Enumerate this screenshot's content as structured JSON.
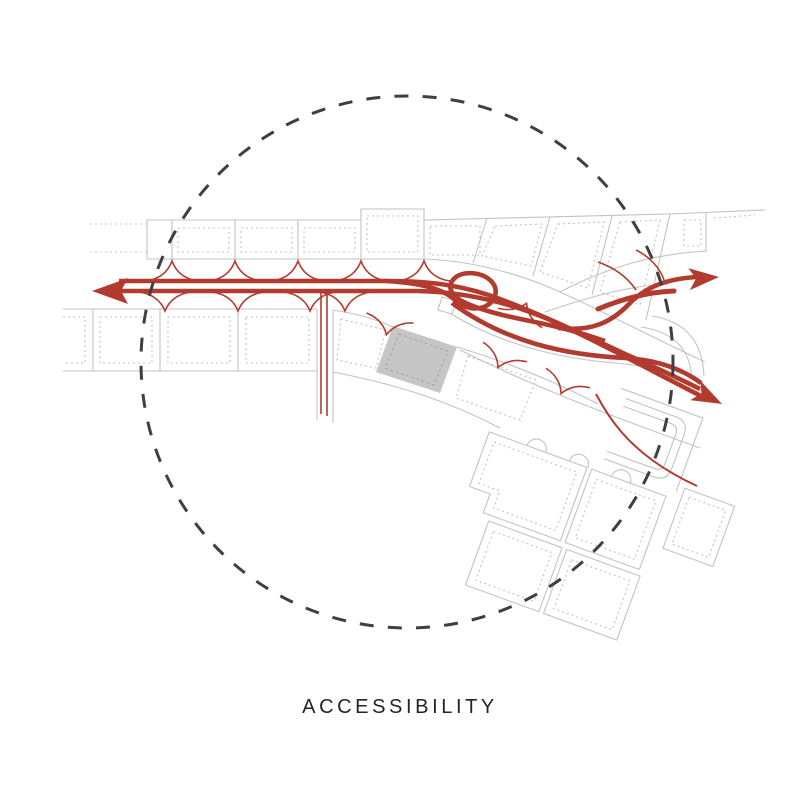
{
  "caption": {
    "label": "ACCESSIBILITY"
  },
  "diagram": {
    "type": "site-accessibility-diagram",
    "features": [
      {
        "name": "radius-circle",
        "style": "dashed"
      },
      {
        "name": "street-grid",
        "style": "light-gray plot parcels with dotted setback lines"
      },
      {
        "name": "route-network",
        "style": "brick-red vehicular routes with interchange loops"
      },
      {
        "name": "plot-access-gates",
        "style": "pointed-arch entries along the main road"
      },
      {
        "name": "site-building",
        "style": "gray filled parcel with dashed inset"
      },
      {
        "name": "route-arrow-west"
      },
      {
        "name": "route-arrow-northeast"
      },
      {
        "name": "route-arrow-southeast"
      }
    ],
    "colors": {
      "background": "#ffffff",
      "route": "#b23a2e",
      "circle": "#3f3f3f",
      "plot_line": "#c3c3c3",
      "plot_dotted": "#c9c0bd",
      "site_fill": "#c6c6c6",
      "site_dash": "#9e9e9e",
      "text": "#242424"
    }
  }
}
